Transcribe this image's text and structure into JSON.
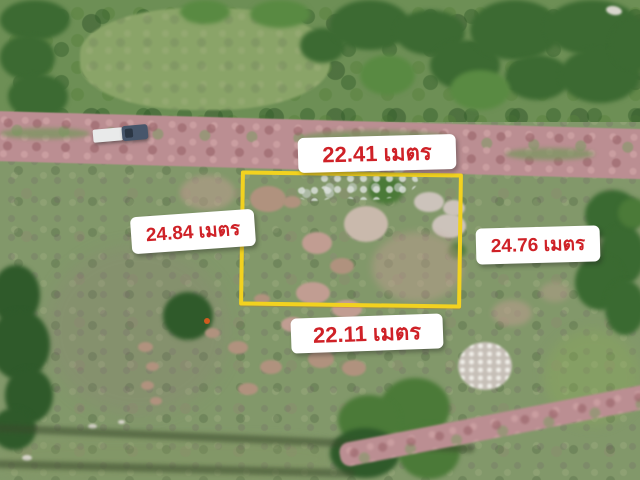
{
  "overlay": {
    "unit": "เมตร",
    "measurements": {
      "top": {
        "label": "22.41 เมตร"
      },
      "left": {
        "label": "24.84 เมตร"
      },
      "right": {
        "label": "24.76 เมตร"
      },
      "bottom": {
        "label": "22.11 เมตร"
      }
    }
  },
  "colors": {
    "boundary_yellow": "#f2d21f",
    "label_text_red": "#cf2127",
    "label_bg": "#ffffff"
  }
}
